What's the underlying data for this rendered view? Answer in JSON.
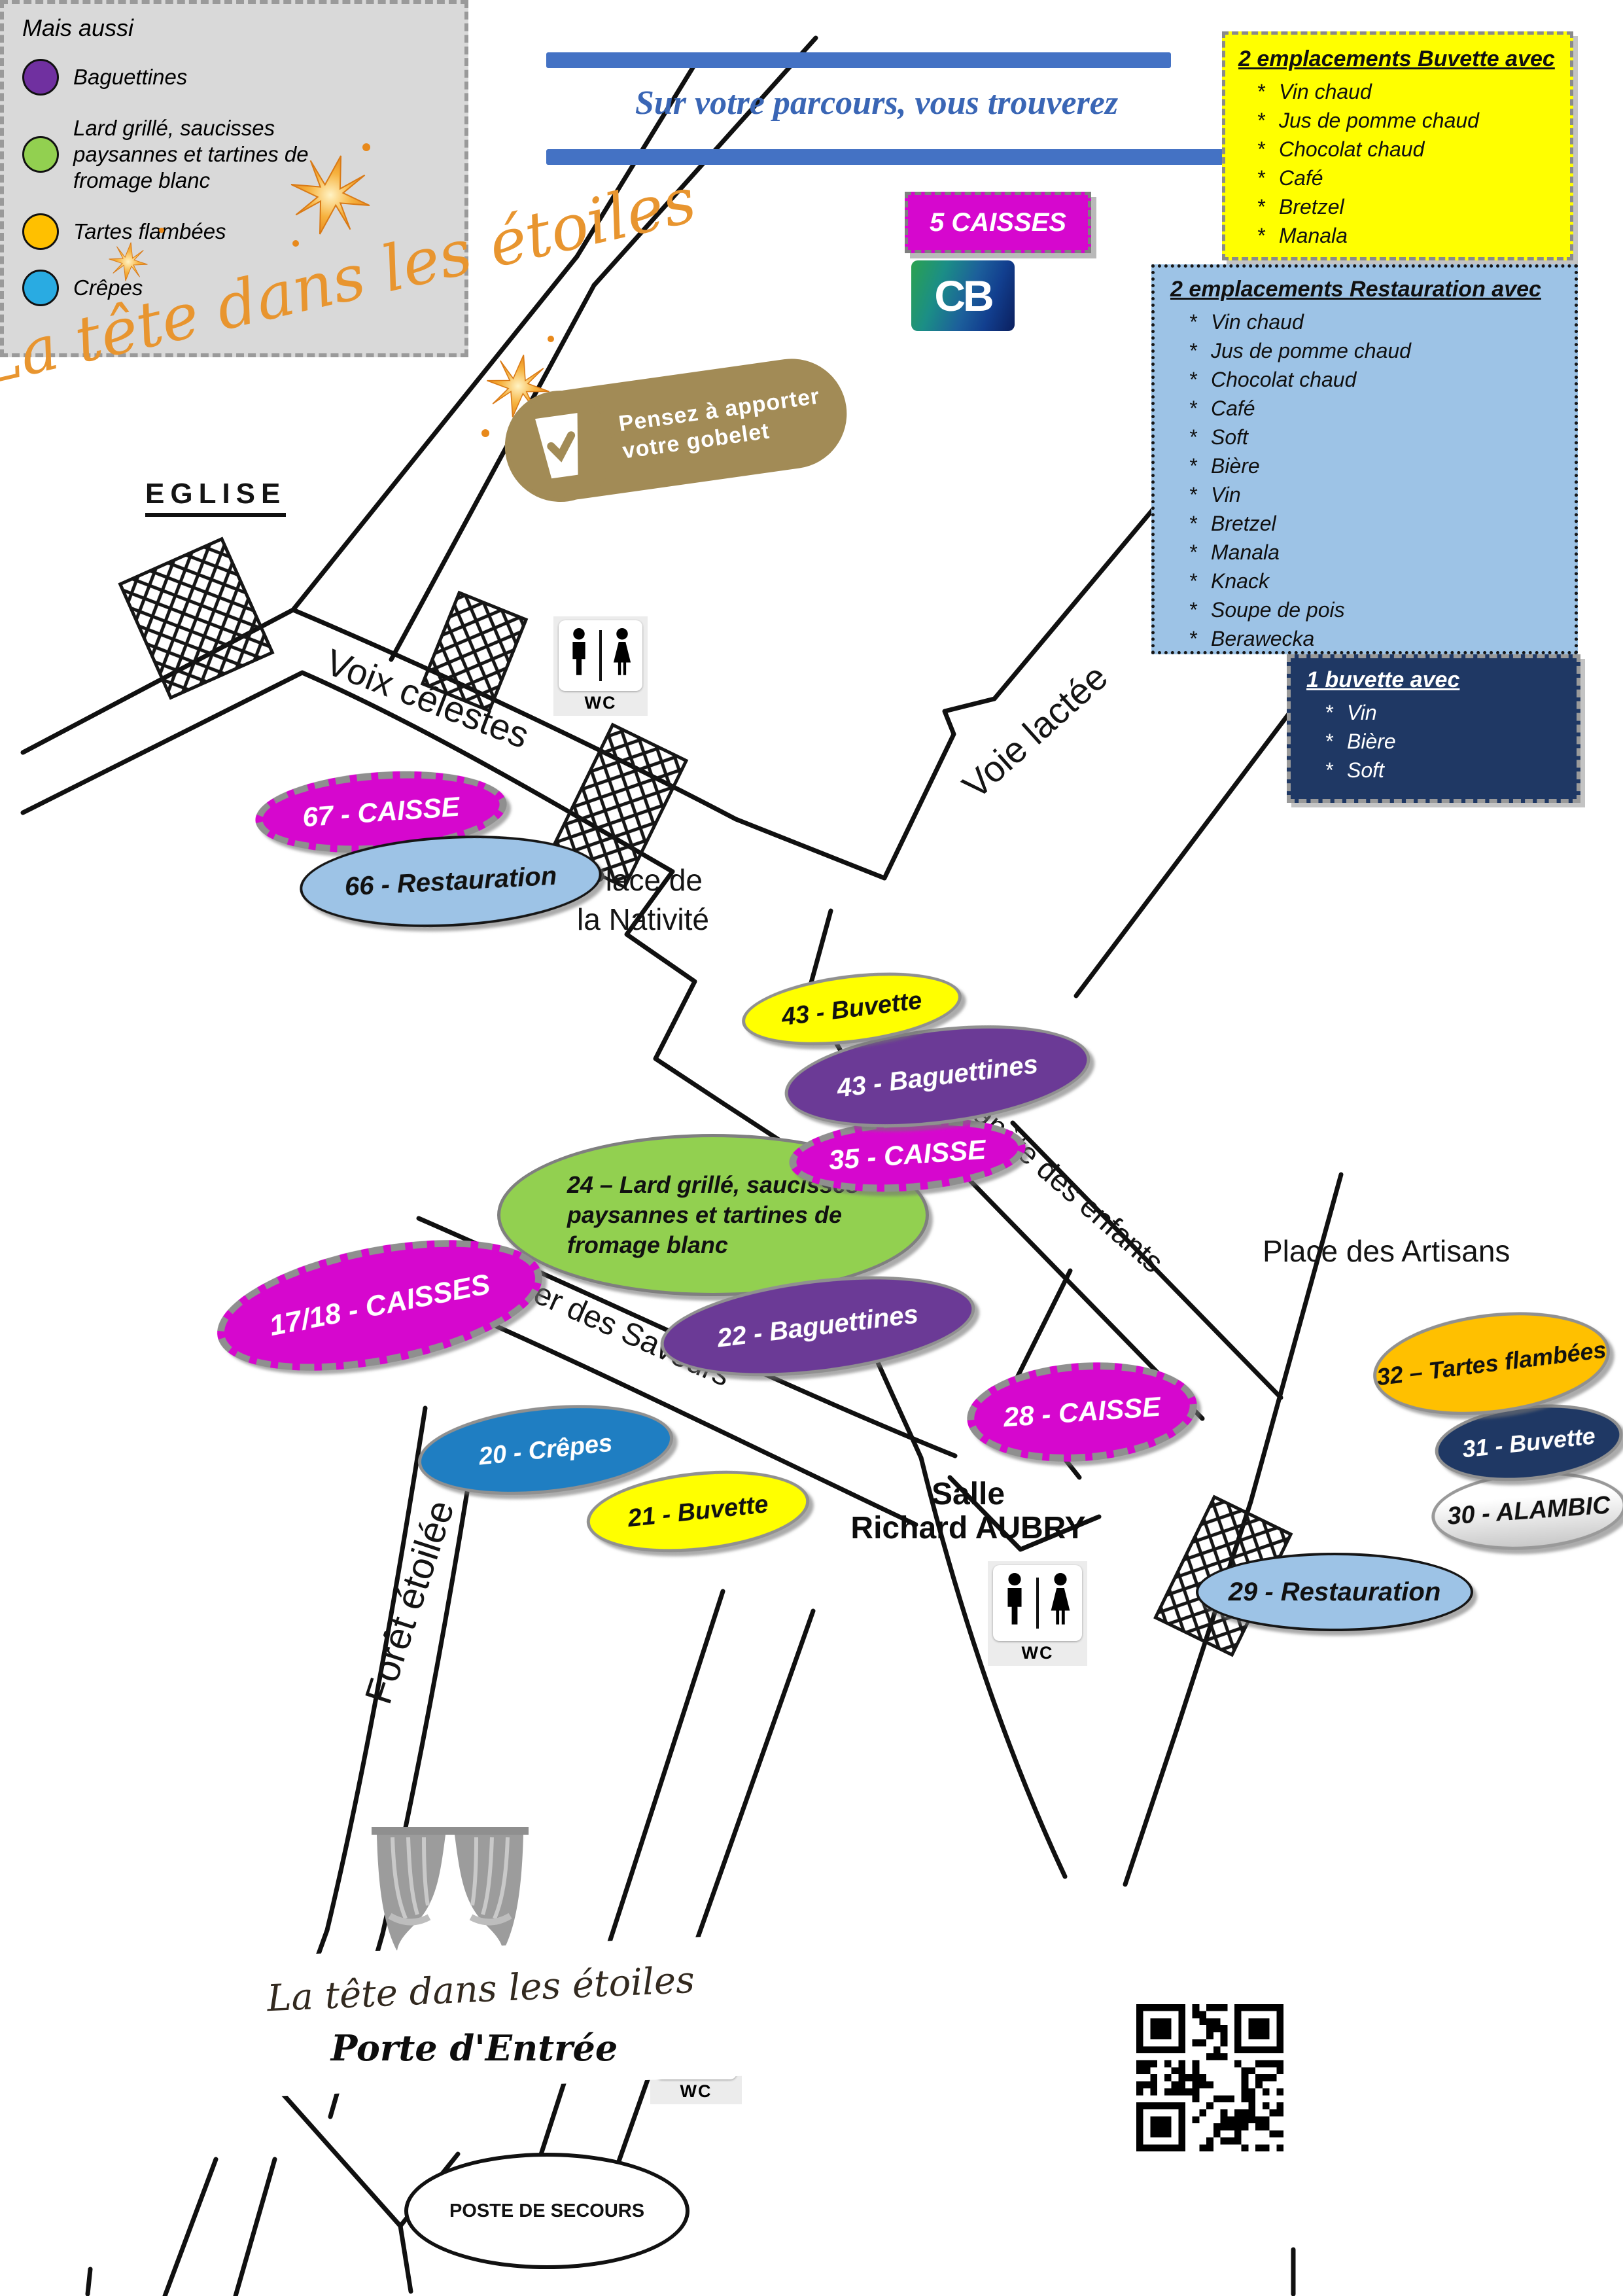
{
  "header": {
    "title": "Sur votre parcours, vous trouverez",
    "accent_color": "#4472C4"
  },
  "branding": {
    "event_title": "La tête dans les étoiles",
    "script_color": "#E8952F"
  },
  "payment": {
    "caisses_badge": "5 CAISSES",
    "cb_logo": "CB"
  },
  "cup_reminder": {
    "line1": "Pensez à apporter",
    "line2": "votre gobelet"
  },
  "info_boxes": {
    "buvette2": {
      "title": "2 emplacements Buvette avec",
      "bg": "#FFFF00",
      "items": [
        "Vin chaud",
        "Jus de pomme chaud",
        "Chocolat chaud",
        "Café",
        "Bretzel",
        "Manala"
      ]
    },
    "restauration2": {
      "title": "2 emplacements Restauration avec",
      "bg": "#9DC3E6",
      "items": [
        "Vin chaud",
        "Jus de pomme chaud",
        "Chocolat chaud",
        "Café",
        "Soft",
        "Bière",
        "Vin",
        "Bretzel",
        "Manala",
        "Knack",
        "Soupe de pois",
        "Berawecka"
      ]
    },
    "buvette1": {
      "title": "1 buvette avec",
      "bg": "#1F3864",
      "items": [
        "Vin",
        "Bière",
        "Soft"
      ]
    },
    "legend": {
      "title": "Mais aussi",
      "bg": "#D9D9D9",
      "entries": [
        {
          "label": "Baguettines",
          "color": "#7030A0"
        },
        {
          "label": "Lard grillé, saucisses paysannes et tartines de fromage blanc",
          "color": "#92D050"
        },
        {
          "label": "Tartes flambées",
          "color": "#FFC000"
        },
        {
          "label": "Crêpes",
          "color": "#29ABE2"
        }
      ]
    }
  },
  "map": {
    "streets": {
      "s1": "Voix célestes",
      "s2": "Voie lactée",
      "s3": "Planète des enfants",
      "s4": "Sentier des Saveurs",
      "s5": "Forêt étoilée"
    },
    "places": {
      "church": "EGLISE",
      "nativite_l1": "Place de",
      "nativite_l2": "la Nativité",
      "artisans": "Place des Artisans",
      "salle_l1": "Salle",
      "salle_l2": "Richard AUBRY"
    },
    "wc": "WC",
    "stands": [
      {
        "label": "67 - CAISSE",
        "color": "#D607CE"
      },
      {
        "label": "66 - Restauration",
        "color": "#9DC3E6"
      },
      {
        "label": "43 - Buvette",
        "color": "#FFFF00"
      },
      {
        "label": "43 - Baguettines",
        "color": "#6B3A96"
      },
      {
        "label": "35 - CAISSE",
        "color": "#D607CE"
      },
      {
        "label": "24 – Lard grillé, saucisses paysannes et tartines de fromage blanc",
        "color": "#92D050"
      },
      {
        "label": "17/18 - CAISSES",
        "color": "#D607CE"
      },
      {
        "label": "22 - Baguettines",
        "color": "#6B3A96"
      },
      {
        "label": "20 - Crêpes",
        "color": "#1F7EC2"
      },
      {
        "label": "21 - Buvette",
        "color": "#FFFF00"
      },
      {
        "label": "28 - CAISSE",
        "color": "#D607CE"
      },
      {
        "label": "32 – Tartes flambées",
        "color": "#FFC000"
      },
      {
        "label": "31 - Buvette",
        "color": "#1F3864"
      },
      {
        "label": "30 - ALAMBIC",
        "color": "#F2F2F2"
      },
      {
        "label": "29 - Restauration",
        "color": "#9DC3E6"
      }
    ],
    "stand24_lines": [
      "24 – Lard grillé, saucisses",
      "paysannes et tartines de",
      "fromage blanc"
    ],
    "first_aid": "POSTE DE SECOURS",
    "entrance": {
      "script": "La tête dans les étoiles",
      "label": "Porte d'Entrée"
    }
  }
}
